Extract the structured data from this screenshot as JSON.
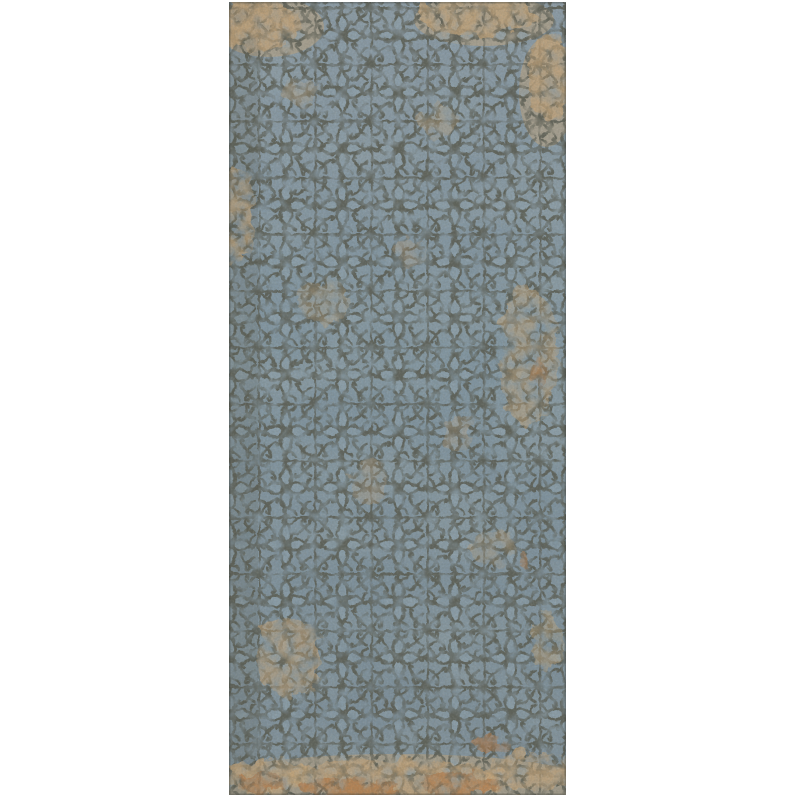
{
  "page": {
    "kind": "product-photo",
    "background": "#ffffff"
  },
  "image": {
    "alt": "Distressed decorative ceramic tile panel with a dark olive-grey ornamental stencil pattern on a blue-grey ground: a square grid with curled cross motifs at intersections, scroll pairs on the grid lines and quatrefoil flowers in each cell, heavily worn with tan and rust patches, strongest along the top corners and bottom edge",
    "bounds": {
      "left": 229,
      "top": 2,
      "width": 337,
      "height": 793
    },
    "grid": {
      "columns": 6,
      "rows": 14,
      "cell_width_px": 56.2,
      "cell_height_px": 56.6,
      "offset_x_px": 29,
      "offset_y_px": 5
    },
    "colors": {
      "canvas_white": "#ffffff",
      "base_blue": "#8094a0",
      "base_top": "#8797a3",
      "base_bottom": "#7b8c97",
      "petal_light": "#8da0ab",
      "ornament_dark": "#575a4f",
      "wear_tan": "#c2a379",
      "wear_rust": "#b07a4c"
    },
    "motifs": [
      "square grid lines",
      "intersection cross with four curled hooks and centre diamond",
      "paired scrolls at grid-line midpoints",
      "four-petal quatrefoil flower in each cell with dark centre diamond",
      "diagonal hooked branches from cell corners toward flower"
    ],
    "wear_zones": [
      "top-left corner tan patch",
      "top-right tan wash",
      "upper-right edge tan streak",
      "left edge tan patch mid-upper",
      "right side tan streak mid-height",
      "bottom-left tan patch",
      "heavy tan and rust band along bottom edge",
      "scattered small flecks overall"
    ]
  }
}
